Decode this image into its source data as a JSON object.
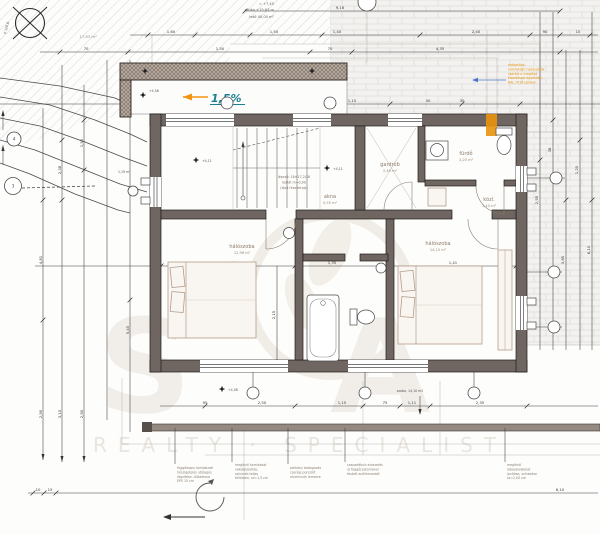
{
  "colors": {
    "accent_teal": "#1a7f92",
    "accent_orange": "#e8940c",
    "wall": "#6f6661",
    "hatch": "#b3a79c"
  },
  "compass": {
    "label": "P 128,6"
  },
  "levels": {
    "l1": "= +7,45",
    "l2": "attika +15,63 m",
    "l3": "tető 40,00 m²"
  },
  "areas": {
    "top_left": "17,63 m²",
    "left_small": "1,19 m²"
  },
  "slope": {
    "value": "1,5%"
  },
  "note_bottom_right": "szoba, 14,10 m2",
  "contour_marks": {
    "c3": "3",
    "c4": "4"
  },
  "level_marks": {
    "m1": "+4,11",
    "m2": "+4,11",
    "m3": "+4,08",
    "m4": "+4,56"
  },
  "rooms": {
    "bedroom_left": {
      "name": "hálószoba",
      "area": "12,96 m²"
    },
    "bedroom_right": {
      "name": "hálószoba",
      "area": "14,10 m²"
    },
    "wardrobe": {
      "name": "gardrób",
      "area": "2,45 m²"
    },
    "bath_top": {
      "name": "fürdő",
      "area": "3,20 m²"
    },
    "hall": {
      "name": "közl.",
      "area": "3,10 m²"
    },
    "shaft": {
      "name": "akna",
      "area": "0,55 m²"
    },
    "stair_note": {
      "l1": "lépcső: 18×17,2/28",
      "l2": "korlát m=0,90",
      "l3": "(lásd részletrajz)"
    }
  },
  "orange_note": {
    "l1": "módosítás:",
    "l2": "homlokzati nyílászárók",
    "l3": "cseréje a meglévő",
    "l4": "kiosztással egyezően,",
    "l5": "RAL 7016 színben"
  },
  "bottom_notes": {
    "n1": [
      "függőleges homlokzati",
      "hőszigetelés utólagos",
      "rögzítése, dübelezve",
      "EPS 15 cm"
    ],
    "n2": [
      "meglévő homlokzat",
      "vakolatjavítás,",
      "színezés teljes",
      "felületen, sz=1,5 cm"
    ],
    "n3": [
      "párkány bádogozás",
      "cseréje porszórt",
      "alumínium lemezre",
      ""
    ],
    "n4": [
      "csapadékvíz elvezetés",
      "új függőcsatornával",
      "festett acéllemezből",
      ""
    ],
    "n5": [
      "meglévő",
      "lábazatvakolat",
      "javítása, színezése",
      "sz=2,00 cm"
    ]
  },
  "watermark": {
    "big1": "S",
    "big2": "A",
    "tagline": "REALTY · SPECIALIST"
  },
  "dims": {
    "top1": "9,16",
    "row35": [
      "1,60",
      "1,50",
      "1,40",
      "2,40",
      "90",
      "10"
    ],
    "row52": [
      "70",
      "1,50",
      "70",
      "4,35"
    ],
    "row88": [
      "1,76",
      "1,35"
    ],
    "row105": [
      "2,38",
      "90",
      "1,15",
      "50",
      "30"
    ],
    "row266": [
      "4,45",
      "1,35",
      "1,41"
    ],
    "row406": [
      "95",
      "2,50",
      "1,15",
      "75",
      "1,11",
      "2,35"
    ],
    "row493": [
      "10",
      "15",
      "6,10"
    ],
    "left_v": [
      "2,38",
      "1,50",
      "4,81",
      "2,90",
      "3,10",
      "2,90",
      "5,45"
    ],
    "right_v": [
      "2,55",
      "38",
      "3,85",
      "1,20",
      "6,10"
    ],
    "v_mid": "2,15"
  }
}
